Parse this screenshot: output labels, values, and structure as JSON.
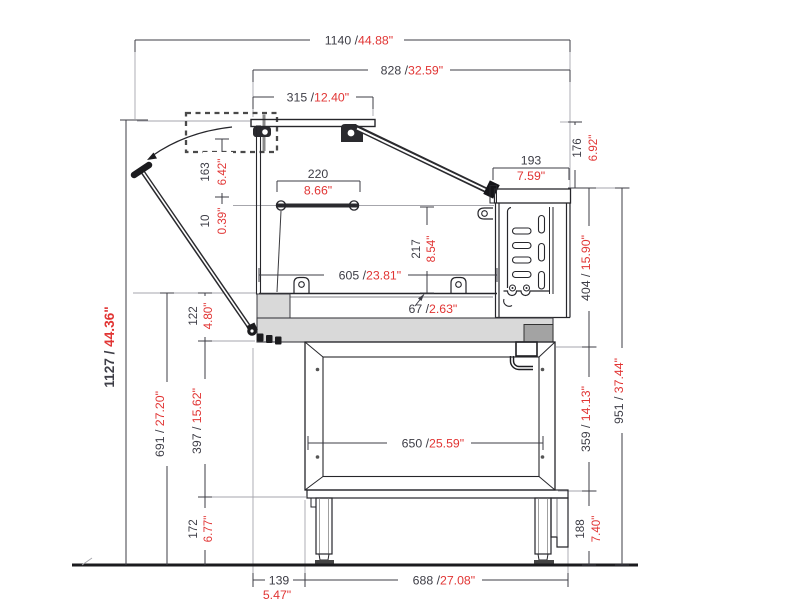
{
  "drawing": {
    "type": "technical-cross-section",
    "subject": "serve-over counter side profile with swing-open front glass",
    "units": "millimetres / inches"
  },
  "colors": {
    "mm_text": "#3d3d46",
    "inch_text": "#e13534",
    "outline": "#26262b",
    "fill_gray": "#d9d9d9"
  },
  "dims": {
    "total_width": {
      "mm": "1140 / ",
      "in": "44.88\""
    },
    "body_width": {
      "mm": "828 / ",
      "in": "32.59\""
    },
    "lid_width": {
      "mm": "315 / ",
      "in": "12.40\""
    },
    "rail_width": {
      "mm": "220",
      "in": "8.66\""
    },
    "rear_top_width": {
      "mm": "193",
      "in": "7.59\""
    },
    "rear_top_height": {
      "mm": "176",
      "in": "6.92\""
    },
    "lid_to_rail": {
      "mm": "163",
      "in": "6.42\""
    },
    "rail_offset": {
      "mm": "10",
      "in": "0.39\""
    },
    "glass_front_height": {
      "mm": "217",
      "in": "8.54\""
    },
    "interior_width": {
      "mm": "605 / ",
      "in": "23.81\""
    },
    "deck_thickness": {
      "mm": "67 / ",
      "in": "2.63\""
    },
    "rear_unit_height": {
      "mm": "404 / ",
      "in": "15.90\""
    },
    "total_height": {
      "mm": "1127 / ",
      "in": "44.36\""
    },
    "counter_height": {
      "mm": "691 / ",
      "in": "27.20\""
    },
    "deck_to_frame": {
      "mm": "122",
      "in": "4.80\""
    },
    "frame_height": {
      "mm": "397 / ",
      "in": "15.62\""
    },
    "leg_height": {
      "mm": "172",
      "in": "6.77\""
    },
    "frame_inner_width": {
      "mm": "650 / ",
      "in": "25.59\""
    },
    "under_height": {
      "mm": "359 / ",
      "in": "14.13\""
    },
    "base_height": {
      "mm": "188",
      "in": "7.40\""
    },
    "rear_total_height": {
      "mm": "951 / ",
      "in": "37.44\""
    },
    "front_offset": {
      "mm": "139",
      "in": "5.47\""
    },
    "base_width": {
      "mm": "688 / ",
      "in": "27.08\""
    }
  }
}
